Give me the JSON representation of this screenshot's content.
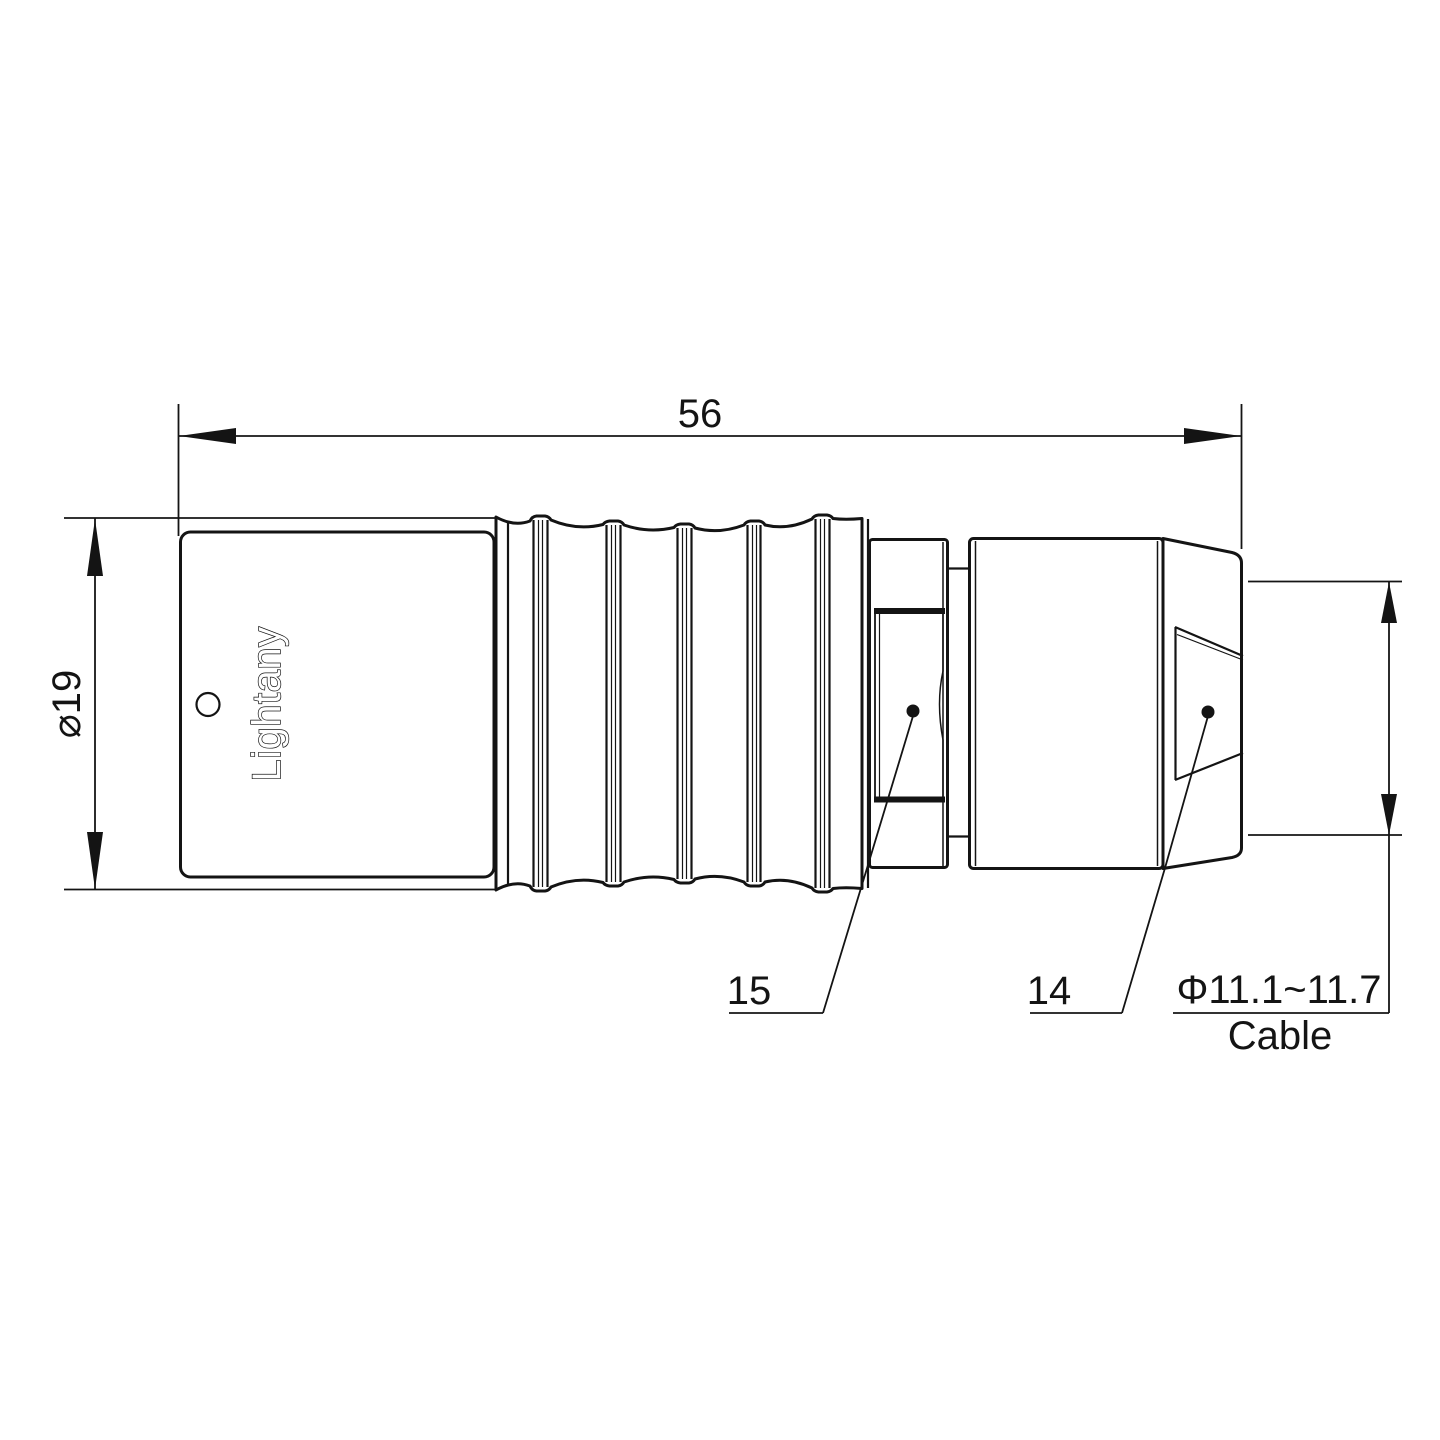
{
  "drawing": {
    "background_color": "#ffffff",
    "line_color": "#141414",
    "watermark_color": "#dd8a86",
    "dimensions": {
      "overall_length": {
        "value": "56"
      },
      "body_diameter": {
        "value": "⌀19"
      },
      "cable_range": {
        "value": "Φ11.1~11.7",
        "label": "Cable"
      }
    },
    "part_labels": {
      "sleeve": "15",
      "nut": "14"
    },
    "brand_text": "Lightany",
    "watermark_text": "Lightany"
  }
}
